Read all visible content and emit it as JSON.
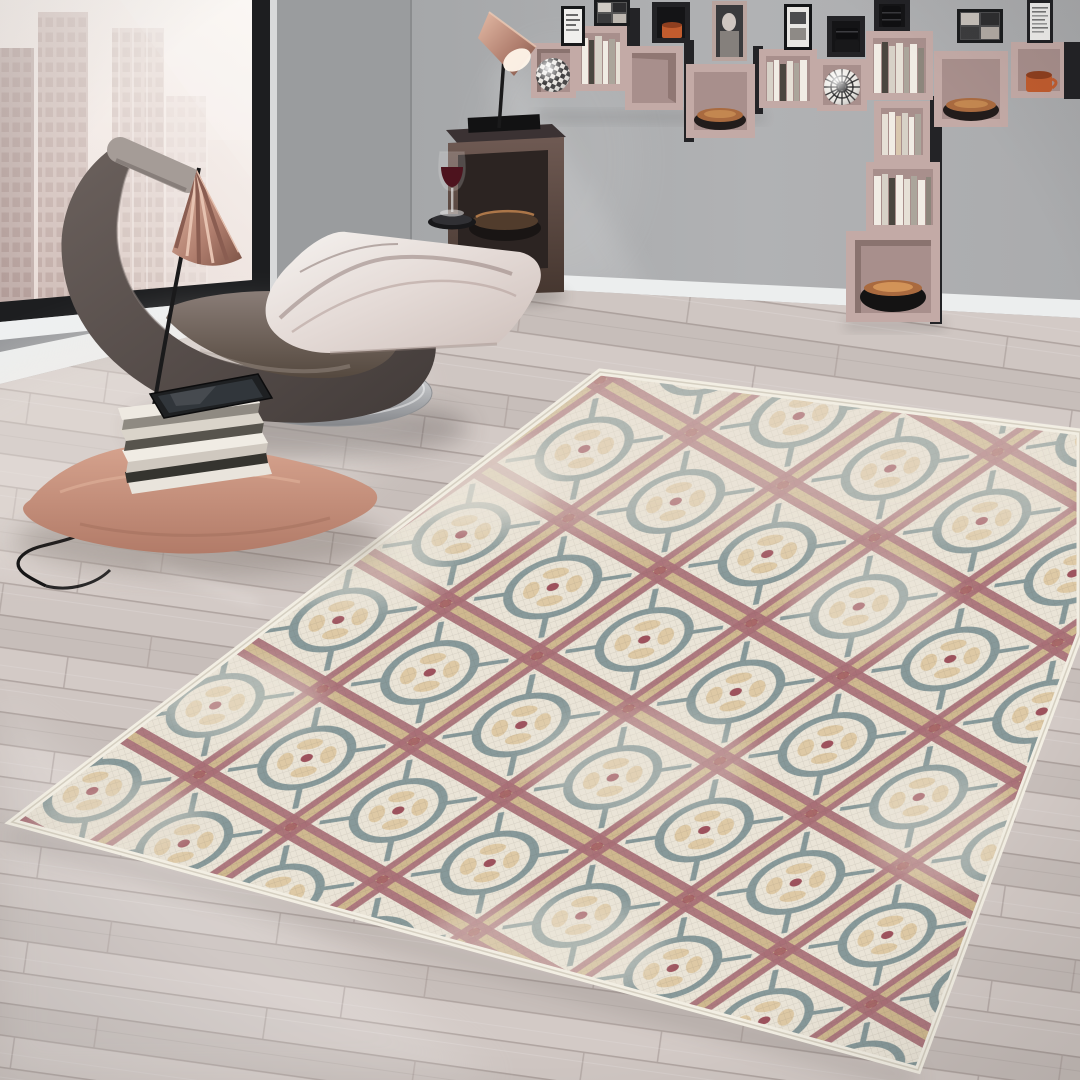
{
  "meta": {
    "description": "Interior lifestyle photograph: modern living room corner staging a distressed mosaic-tile area rug",
    "image_type": "photograph",
    "visible_text": "none"
  },
  "palette": {
    "wall_main": "#a8aaac",
    "wall_shaded": "#9a9c9e",
    "window_frame": "#1d1e20",
    "window_trim": "#d8d9da",
    "sill": "#eef0f1",
    "baseboard": "#eceeee",
    "city_haze": "#f2eae6",
    "building": "#c9b7b2",
    "floor_base": "#ccc3bf",
    "floor_seam": "#afa49f",
    "floor_highlight": "#efe9e4",
    "rug_cream": "#eae4d7",
    "rug_teal": "#87999a",
    "rug_rose": "#a86f77",
    "rug_khaki": "#cfb88f",
    "rug_petal": "#dcc49c",
    "rug_red": "#9e525d",
    "rug_fringe": "#f2eee3",
    "chair_shell": "#584f4c",
    "chair_roll": "#a59c97",
    "chair_seat": "#6e625c",
    "chrome": "#c9cacd",
    "pillow_marble": "#efe9e6",
    "marble_vein": "#93807c",
    "shade_copper": "#c09283",
    "lamp_black": "#1a1a1b",
    "table_bronze": "#5e4c47",
    "shelf_pink": "#c3aaa6",
    "shelf_interior": "#a88f8c",
    "shelf_black": "#232326",
    "book_light": "#f1ece4",
    "book_dark": "#4a463f",
    "mug_orange": "#c15c2e",
    "bowl_copper": "#a96a3f",
    "cushion_pink": "#cf9a85",
    "cable": "#161617"
  },
  "scene": {
    "window": {
      "position": "left wall",
      "frame_color": "black",
      "view": "hazy high-rise city skyline in warm gray-pink haze",
      "building_count": 5
    },
    "wall_shelves": {
      "style": "staggered wall-mounted cube shelves with T-shaped column",
      "cube_colors": [
        "dusty pink",
        "black"
      ],
      "pink_cube_count": 12,
      "black_cube_count": 3,
      "framed_prints_count": 6,
      "contents": [
        "books",
        "checkered deco sphere",
        "op-art radial sphere",
        "copper bowls",
        "large black bowl",
        "black canisters",
        "orange ceramic mugs",
        "monochrome framed prints"
      ]
    },
    "seating": {
      "type": "sculptural leather lounge chair",
      "color": "dark taupe suede",
      "base": "polished chrome pedestal disc",
      "pillow": "white-gray marbled cushion"
    },
    "lamps": [
      {
        "type": "leaning floor reading lamp",
        "shade": "pleated copper fan cone",
        "pole": "thin black rod"
      },
      {
        "type": "task lamp on cube table",
        "shade": "glossy copper cone",
        "state": "on, casting light wedge on wall"
      }
    ],
    "side_table": {
      "type": "open cube side table",
      "color": "dark bronze",
      "contents": "metal bowl with copper rim"
    },
    "drink": {
      "type": "glass of red wine",
      "resting_on": "black round tray on marbled pillow"
    },
    "floor_items": {
      "cushion": "salmon pink floor pillow",
      "book_stack_count": 8,
      "tablet_count": 1,
      "cable": "black lamp cord coiling to lower left"
    },
    "rug": {
      "type": "rectangular area rug shown at an angle",
      "style": "distressed antique mosaic / micro-tile",
      "base_color": "ivory cream",
      "motifs": [
        "interlocking teal circles",
        "rose-red lattice bands with khaki cores",
        "khaki petal rosettes",
        "small red center dots"
      ],
      "edge": "ivory fringe border",
      "condition": "worn / faded patches"
    },
    "floor": {
      "material": "light gray-beige laminate planks",
      "lighting": "bright sheen near window, soft shadows under furniture"
    }
  }
}
